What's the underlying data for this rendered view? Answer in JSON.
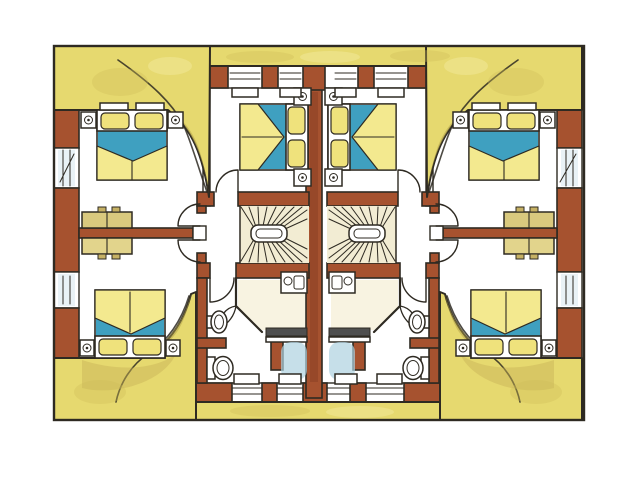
{
  "meta": {
    "kind": "hand-drawn watercolor architectural floor plan (scanned drawing)",
    "canvas": {
      "width": 640,
      "height": 480
    },
    "layout": "two mirrored residential units separated by a central party wall"
  },
  "colors": {
    "paper": "#ffffff",
    "ink": "#2e2a22",
    "roof_yellow": "#e6d96f",
    "roof_yellow_deep": "#cdbd5a",
    "roof_shadow": "#b2a24a",
    "roof_ochre": "#c8b257",
    "wall_red": "#a6522f",
    "wall_red_deep": "#7e3b20",
    "window_white": "#ffffff",
    "glass_blue": "#d7e8ee",
    "bed_yellow": "#f3e98f",
    "pillow_yellow": "#efe27c",
    "accent_blue": "#3fa0c0",
    "water_blue": "#aed2e0",
    "furniture_tan": "#d9c97e",
    "furniture_tan_dark": "#c6b164",
    "stair_cream": "#f2ecd3",
    "bath_cream": "#f6f0da",
    "screen_grey": "#4f4f4f"
  },
  "inventory": {
    "units": [
      "left",
      "right"
    ],
    "rooms_per_unit": [
      "bedroom-outer-top",
      "bedroom-center-top",
      "bedroom-bottom",
      "bathroom",
      "hall",
      "winder-staircase"
    ],
    "furniture_counts": {
      "double_beds": 6,
      "wardrobes": 2,
      "nightstands_with_lamps": 12,
      "staircases": 2
    },
    "bathroom_fixtures_per_unit": [
      "washbasin-vanity",
      "corner-shower",
      "wall-sink",
      "toilet"
    ],
    "opening_counts": {
      "exterior_windows": 10,
      "interior_doors_per_unit": 4,
      "shower_doors_per_unit": 1
    },
    "roof_features": [
      "top-eave-band",
      "bottom-eave-band",
      "four-corner-roof-surfaces-with-curved-dormer-edges"
    ]
  }
}
